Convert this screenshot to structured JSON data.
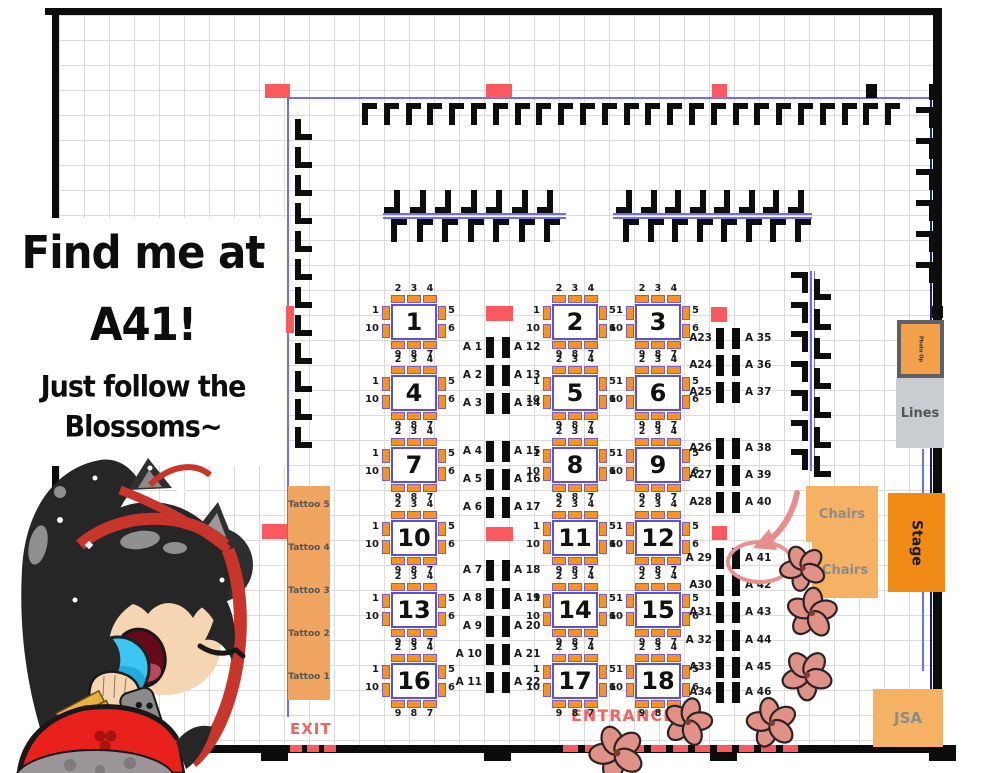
{
  "signage": {
    "lines": [
      "Find me at",
      "A41!",
      "Just follow the",
      "Blossoms~"
    ]
  },
  "map": {
    "exit_label": "EXIT",
    "entrance_label": "ENTRANCE",
    "tattoo_stations": [
      "Tattoo 5",
      "Tattoo 4",
      "Tattoo 3",
      "Tattoo 2",
      "Tattoo 1"
    ],
    "areas": {
      "photo_op": "Photo Op",
      "lines": "Lines",
      "chairs_top": "Chairs",
      "chairs_bottom": "Chairs",
      "stage": "Stage",
      "jsa": "JSA"
    },
    "tables": {
      "numbers": [
        "1",
        "2",
        "3",
        "4",
        "5",
        "6",
        "7",
        "8",
        "9",
        "10",
        "11",
        "12",
        "13",
        "14",
        "15",
        "16",
        "17",
        "18"
      ],
      "seat_labels": {
        "top": "2 3 4",
        "left_upper": "1",
        "left_lower": "10",
        "right_upper": "5",
        "right_lower": "6",
        "bottom": "9 8 7"
      }
    },
    "artist_seats": {
      "mid_left": [
        "A 1",
        "A 2",
        "A 3",
        "A 4",
        "A 5",
        "A 6",
        "A 7",
        "A 8",
        "A 9",
        "A 10",
        "A 11"
      ],
      "mid_right": [
        "A 12",
        "A 13",
        "A 14",
        "A 15",
        "A 16",
        "A 17",
        "A 18",
        "A 19",
        "A 20",
        "A 21",
        "A 22"
      ],
      "right_left": [
        "A23",
        "A24",
        "A25",
        "A26",
        "A27",
        "A28",
        "A 29",
        "A30",
        "A31",
        "A 32",
        "A33",
        "A34"
      ],
      "right_right": [
        "A 35",
        "A 36",
        "A 37",
        "A 38",
        "A 39",
        "A 40",
        "A 41",
        "A 42",
        "A 43",
        "A 44",
        "A 45",
        "A 46"
      ],
      "highlighted": "A 41"
    },
    "colors": {
      "accent_red": "#f9595f",
      "seat_orange": "#f7941d",
      "booth_blue": "#6e6ef5",
      "table_border_purple": "#5b50d8",
      "highlight_pink": "#ec8f8f",
      "stage_orange": "#f08c16",
      "area_orange": "#f6b264",
      "tattoo_orange": "#efa55f",
      "lines_gray": "#c9ccd1",
      "door_label_red": "#f4635f",
      "blossom_pink": "#e09289"
    }
  }
}
